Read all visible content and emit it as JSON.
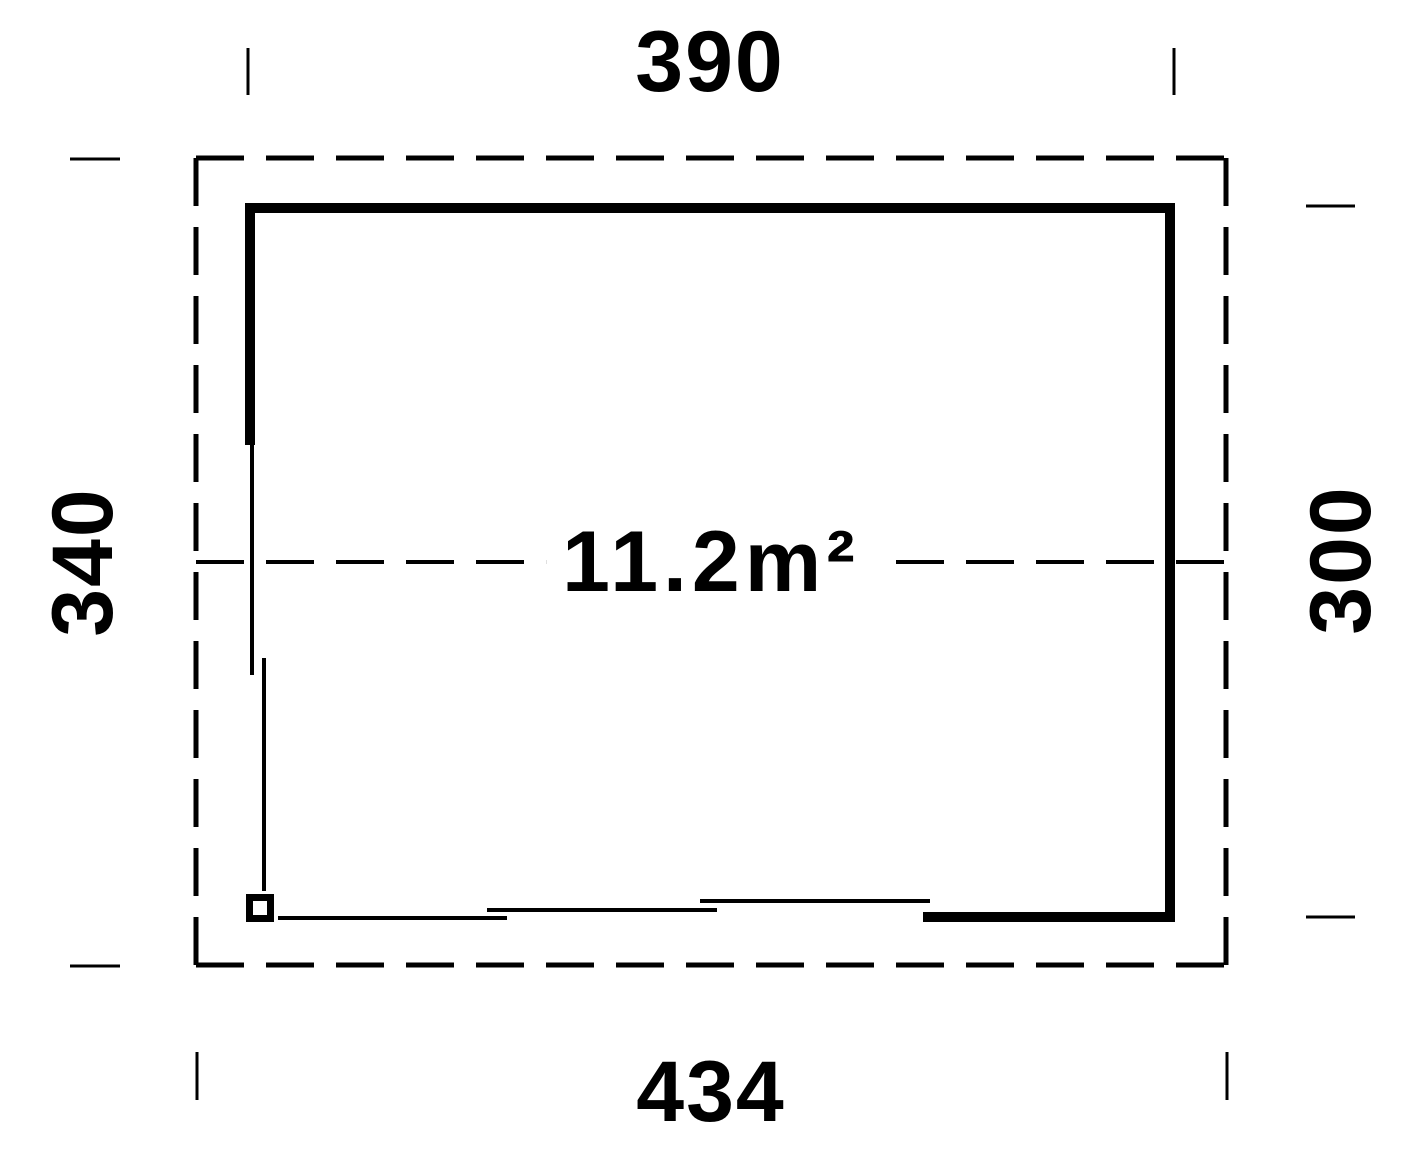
{
  "floorplan": {
    "dimensions": {
      "top_width": "390",
      "left_height": "340",
      "right_height": "300",
      "bottom_width": "434"
    },
    "area_label": "11.2m²",
    "colors": {
      "line": "#000000",
      "background": "#ffffff"
    }
  }
}
